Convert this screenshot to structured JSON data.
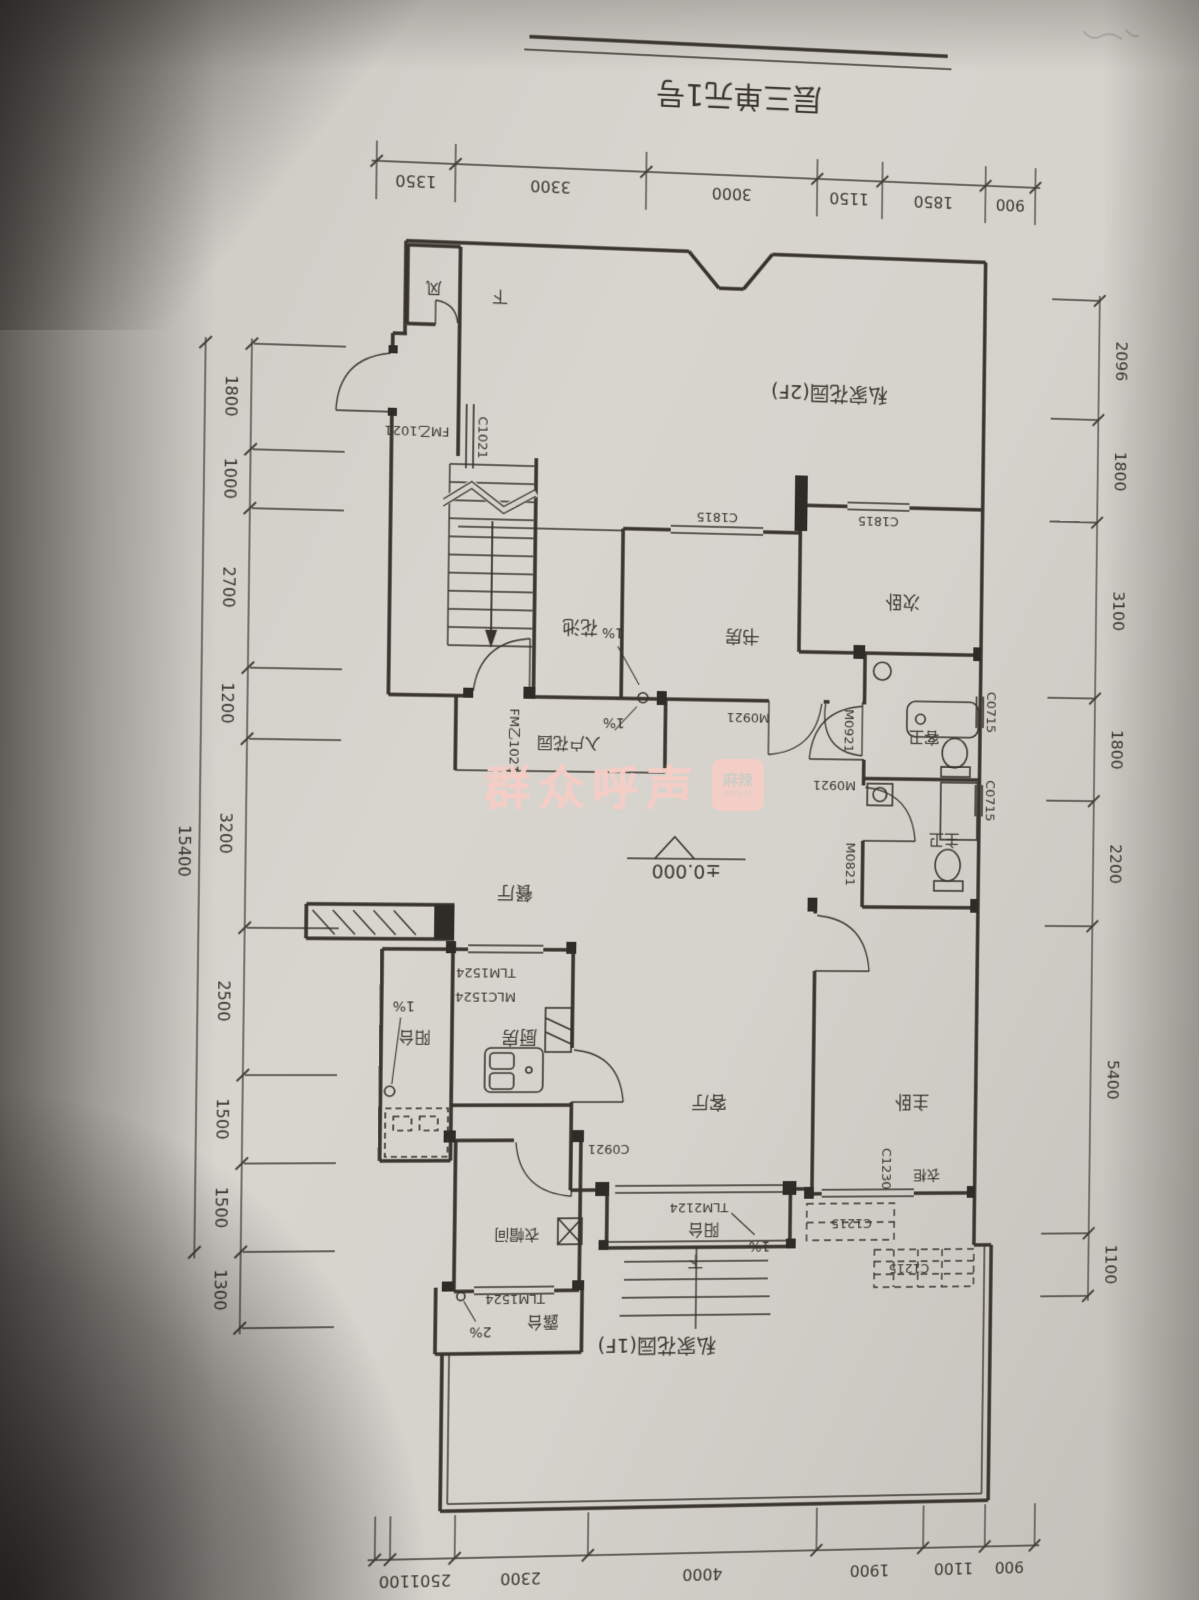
{
  "title": {
    "text": "层三单元1号"
  },
  "watermark": {
    "text": "群众呼声",
    "badge_top": "麻辣",
    "badge_bottom": "mala.cn"
  },
  "elevation": {
    "value": "±0.000"
  },
  "dims": {
    "top": [
      "1350",
      "3300",
      "3000",
      "1150",
      "1850",
      "900"
    ],
    "bottom": [
      "2501100",
      "2300",
      "4000",
      "1900",
      "1100",
      "900"
    ],
    "left": [
      "1800",
      "1000",
      "2700",
      "1200",
      "3200",
      "2500",
      "1500",
      "1500",
      "1300"
    ],
    "left_total": "15400",
    "right": [
      "2096",
      "1800",
      "3100",
      "1800",
      "2200",
      "5400",
      "1100"
    ]
  },
  "rooms": {
    "garden_2f": "私家花园(2F)",
    "garden_1f": "私家花园(1F)",
    "flower_bed": "花池",
    "study": "书房",
    "second_bedroom": "次卧",
    "entry_garden": "入户花园",
    "guest_bath": "客卫",
    "master_bath": "主卫",
    "dining": "餐厅",
    "living": "客厅",
    "master_bedroom": "主卧",
    "kitchen": "厨房",
    "service_balcony": "阳台",
    "cloakroom": "衣帽间",
    "front_balcony": "阳台",
    "terrace": "露台",
    "wardrobe": "衣柜",
    "vent_shaft": "风",
    "stair_down": "下",
    "balcony_down": "下"
  },
  "codes": {
    "c1021": "C1021",
    "fm_1021": "FM乙1021",
    "c1815": "C1815",
    "m0921": "M0921",
    "m0821": "M0821",
    "c0715": "C0715",
    "tlm1524": "TLM1524",
    "mlc1524": "MLC1524",
    "tlm2124": "TLM2124",
    "c1215": "C1215",
    "c1230": "C1230",
    "c0921": "C0921"
  },
  "slopes": {
    "one_percent": "1%",
    "two_percent": "2%"
  }
}
